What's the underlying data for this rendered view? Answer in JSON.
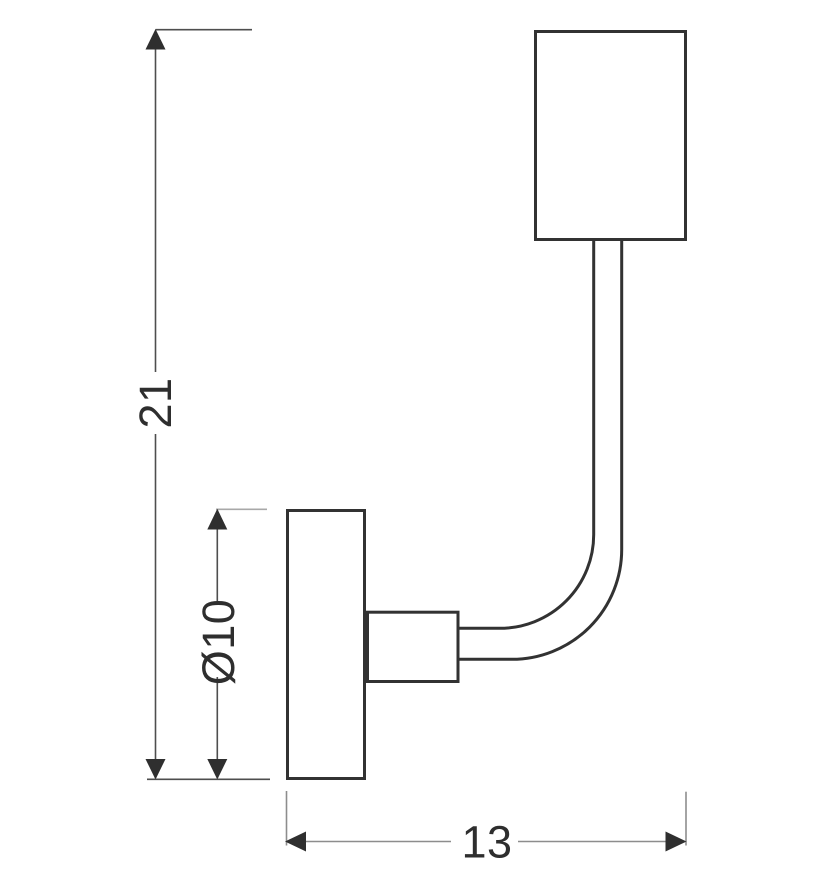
{
  "diagram": {
    "type": "technical-dimension-drawing",
    "subject": "wall lamp side elevation",
    "dimensions": {
      "height": {
        "label": "21",
        "orientation": "vertical"
      },
      "plate_diameter": {
        "label": "Ø10",
        "orientation": "vertical"
      },
      "depth": {
        "label": "13",
        "orientation": "horizontal"
      }
    },
    "colors": {
      "outline": "#323232",
      "dimension_line": "#4e4e4e",
      "depth_dimension_line": "#8d8d8d",
      "extension_line_light": "#a8a8a8",
      "arrow": "#2f2f2f",
      "text": "#2e2e2e",
      "background": "#ffffff"
    }
  }
}
